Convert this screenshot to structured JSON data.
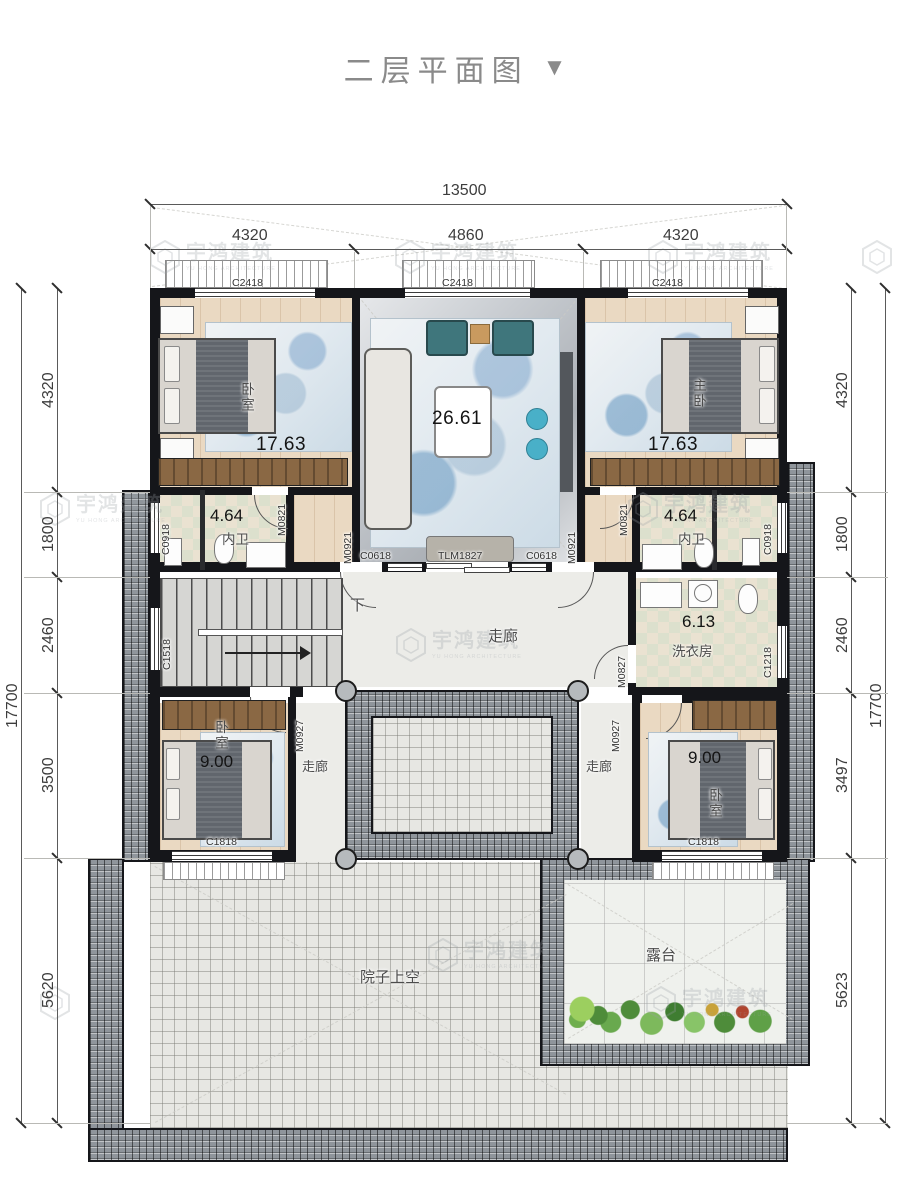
{
  "title": {
    "text": "二层平面图",
    "arrow": "▼"
  },
  "watermark": {
    "cn": "宇鸿建筑",
    "en": "YU HONG ARCHITECTURE"
  },
  "dims": {
    "top_total": "13500",
    "top_segs": [
      "4320",
      "4860",
      "4320"
    ],
    "left_segs": [
      "4320",
      "1800",
      "2460",
      "3500",
      "5620"
    ],
    "left_total": "17700",
    "right_segs": [
      "4320",
      "1800",
      "2460",
      "3497",
      "5623"
    ],
    "right_total": "17700"
  },
  "rooms": {
    "bedroom_ul": {
      "name": "卧室",
      "area": "17.63"
    },
    "living": {
      "area": "26.61"
    },
    "bedroom_ur": {
      "name": "主卧",
      "area": "17.63"
    },
    "bath_l": {
      "name": "内卫",
      "area": "4.64"
    },
    "bath_r": {
      "name": "内卫",
      "area": "4.64"
    },
    "laundry": {
      "name": "洗衣房",
      "area": "6.13"
    },
    "corridor": "走廊",
    "stairs_down": "下",
    "bedroom_ll": {
      "name": "卧室",
      "area": "9.00"
    },
    "bedroom_lr": {
      "name": "卧室",
      "area": "9.00"
    },
    "courtyard": "院子上空",
    "terrace": "露台"
  },
  "openings": {
    "c2418": "C2418",
    "c0918": "C0918",
    "m0821": "M0821",
    "m0921": "M0921",
    "c0618": "C0618",
    "tlm1827": "TLM1827",
    "c1518": "C1518",
    "m0827": "M0827",
    "c1218": "C1218",
    "m0927": "M0927",
    "c1818": "C1818"
  }
}
